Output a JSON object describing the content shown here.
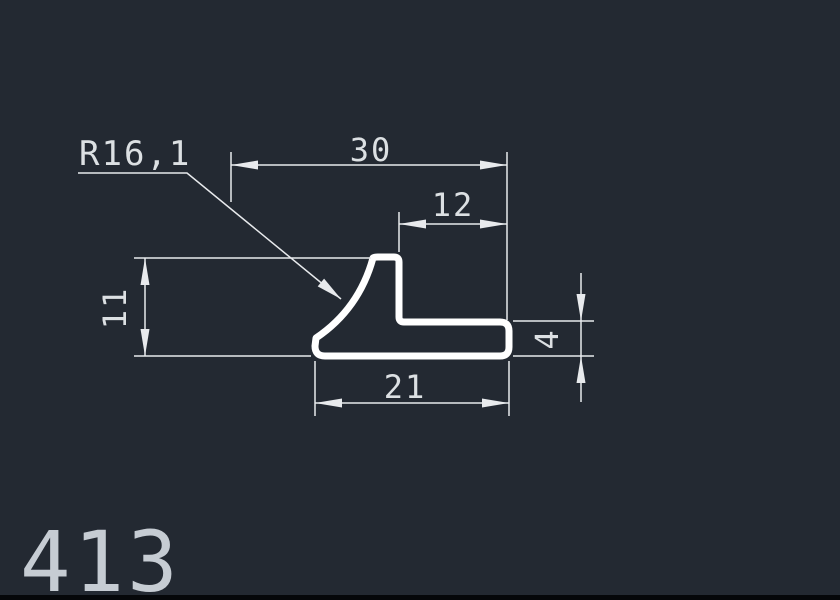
{
  "drawing": {
    "kind": "cad-profile-cross-section",
    "part_number": "413",
    "dimensions": {
      "radius": "R16,1",
      "width_top": "30",
      "width_step": "12",
      "height_left": "11",
      "height_right": "4",
      "width_bottom": "21"
    },
    "colors": {
      "background": "#232932",
      "profile_line": "#ffffff",
      "dimension_line": "#e8eaed",
      "dimension_text": "#dce0e3",
      "part_label": "#c6ccd3",
      "bottom_bar": "#05070a"
    }
  }
}
